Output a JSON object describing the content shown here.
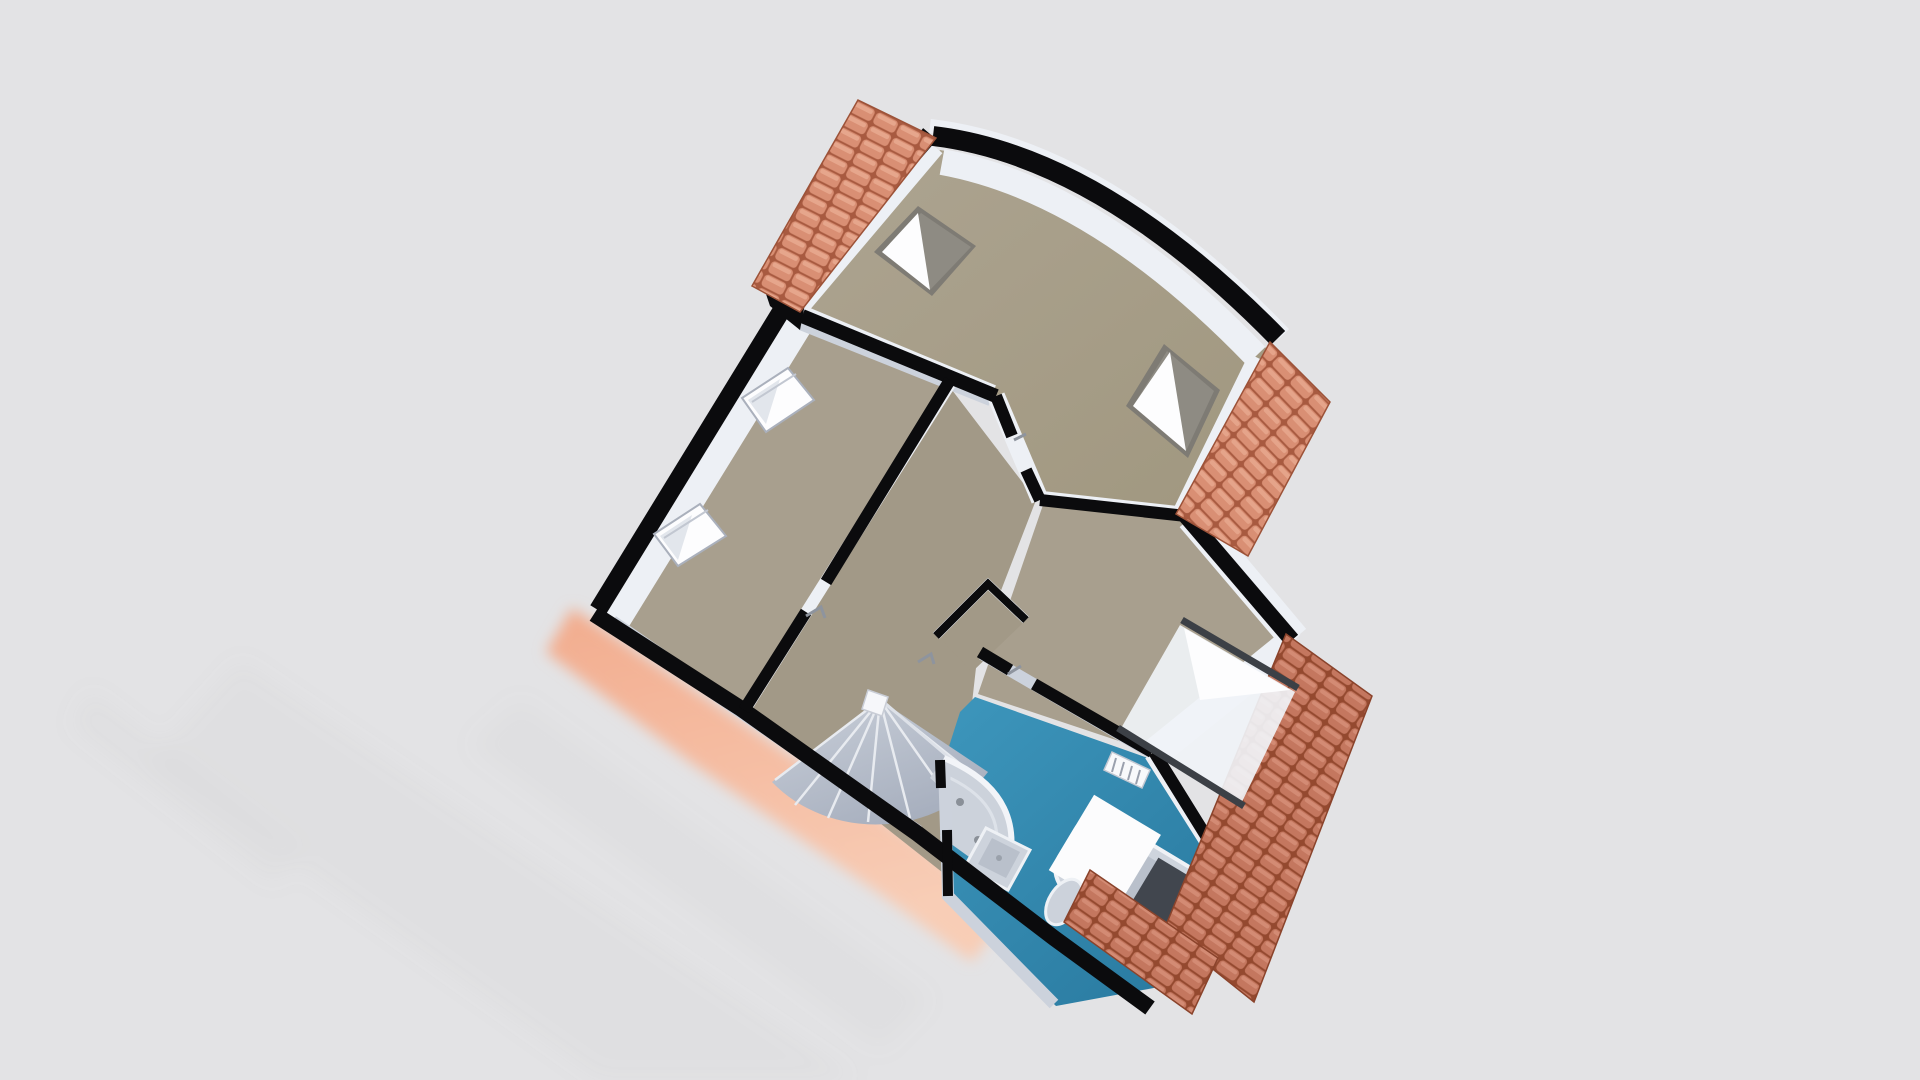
{
  "scene": {
    "kind": "3d-floor-plan-render",
    "description": "Aerial dollhouse-style 3D render of an upper storey floor plan on a plain pale-grey backdrop, plan rotated roughly 30 degrees clockwise; cut wall tops are black, wall faces white, floors taupe, bathroom floor teal, roof eaves in terracotta tile",
    "visible_text": "none"
  },
  "palette": {
    "bg": "#e3e3e5",
    "floor": "#a89f8e",
    "floor2": "#a29987",
    "wall": "#0b0b0d",
    "wallface": "#edf0f5",
    "wallfacedim": "#ccd2dc",
    "roof": "#d98f74",
    "roofdark": "#a85a40",
    "rooflight": "#edb29a",
    "roofdeep": "#c4775f",
    "roofdeepdark": "#94492f",
    "eave": "#f4bfa4",
    "bath": "#2f87ad",
    "bathlight": "#3d96bc",
    "stair": "#b3bac7",
    "stairlight": "#c9cfd9",
    "stairline": "#e8ebf0",
    "fixture": "#ccd2db",
    "fixturedeep": "#b9c0cb",
    "frame": "#3c4046",
    "glass": "#8e8b83",
    "bright": "#fdfdfe",
    "shadow": "#9a9aa0"
  },
  "rooms": [
    {
      "id": "loft-room-north",
      "floor_color_key": "floor",
      "features": [
        "curved north wall",
        "two roof skylights (angled glazed panels)",
        "gable roof strip on north-west edge"
      ]
    },
    {
      "id": "bedroom-west",
      "floor_color_key": "floor",
      "features": [
        "two roof windows low on west sloped wall",
        "door to landing"
      ]
    },
    {
      "id": "landing-stairwell",
      "floor_color_key": "floor",
      "features": [
        "fan of winder stairs",
        "white newel post",
        "handrail"
      ]
    },
    {
      "id": "cupboard-center",
      "floor_color_key": "floor",
      "features": [
        "small store between landing, bedroom and bathroom"
      ]
    },
    {
      "id": "bedroom-east",
      "floor_color_key": "floor",
      "features": [
        "wide dormer window on south-east wall",
        "radiator"
      ]
    },
    {
      "id": "bathroom-south",
      "floor_color_key": "bath",
      "fixtures": [
        "corner shower",
        "washbasin",
        "toilet",
        "bathtub",
        "white bath panel",
        "dark bath mat"
      ]
    }
  ],
  "roof_sections": [
    {
      "id": "roof-nw-gable"
    },
    {
      "id": "roof-ne-eave"
    },
    {
      "id": "roof-east-eave"
    },
    {
      "id": "roof-south-eave"
    },
    {
      "id": "roof-sw-eave-blurred"
    }
  ],
  "counts": {
    "skylights": 2,
    "west_roof_windows": 2,
    "dormer_windows": 1,
    "rooms": 6,
    "roof_sections": 5
  }
}
